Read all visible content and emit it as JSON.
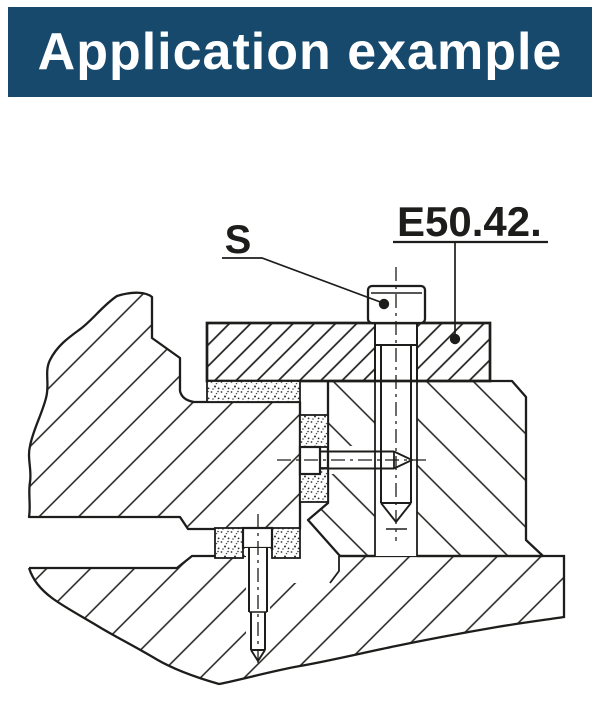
{
  "header": {
    "title": "Application example",
    "bg_color": "#17496d",
    "text_color": "#ffffff"
  },
  "drawing": {
    "screw_label": "S",
    "part_label": "E50.42.",
    "line_color": "#1d1d1b",
    "paper_color": "#ffffff"
  }
}
